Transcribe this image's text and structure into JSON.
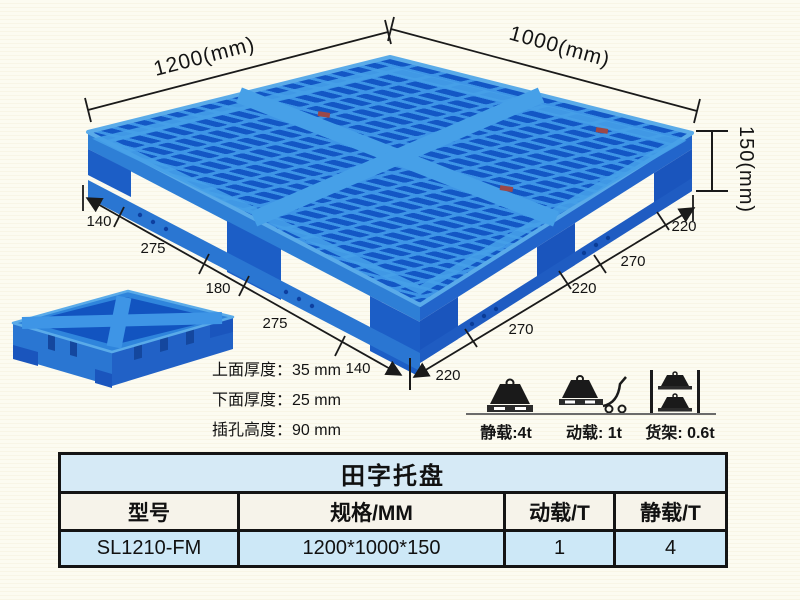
{
  "dims": {
    "top_left": "1200(mm)",
    "top_right": "1000(mm)",
    "side_height": "150(mm)",
    "left_chain": [
      "140",
      "275",
      "180",
      "275",
      "140"
    ],
    "right_chain": [
      "220",
      "270",
      "220",
      "270",
      "220"
    ]
  },
  "notes": {
    "line1": "上面厚度：35 mm",
    "line2": "下面厚度：25 mm",
    "line3": "插孔高度：90 mm"
  },
  "load_ratings": {
    "static": "静载:4t",
    "dynamic": "动载: 1t",
    "rack": "货架: 0.6t"
  },
  "icons": {
    "static": "weight-on-pallet-icon",
    "dynamic": "weight-on-trolley-icon",
    "rack": "weights-on-rack-icon"
  },
  "spec_table": {
    "title": "田字托盘",
    "headers": [
      "型号",
      "规格/MM",
      "动载/T",
      "静载/T"
    ],
    "row": [
      "SL1210-FM",
      "1200*1000*150",
      "1",
      "4"
    ]
  },
  "colors": {
    "pallet_rib": "#3e95e6",
    "pallet_hole": "#1357c5",
    "pallet_side": "#2e7fd6",
    "pallet_foot": "#1c5ec6",
    "table_title_bg": "#d6eaf6",
    "table_header_bg": "#f6f3ea",
    "table_row_bg": "#cde8f7",
    "line_color": "#1a1a1a",
    "background": "#fcfbf1"
  }
}
